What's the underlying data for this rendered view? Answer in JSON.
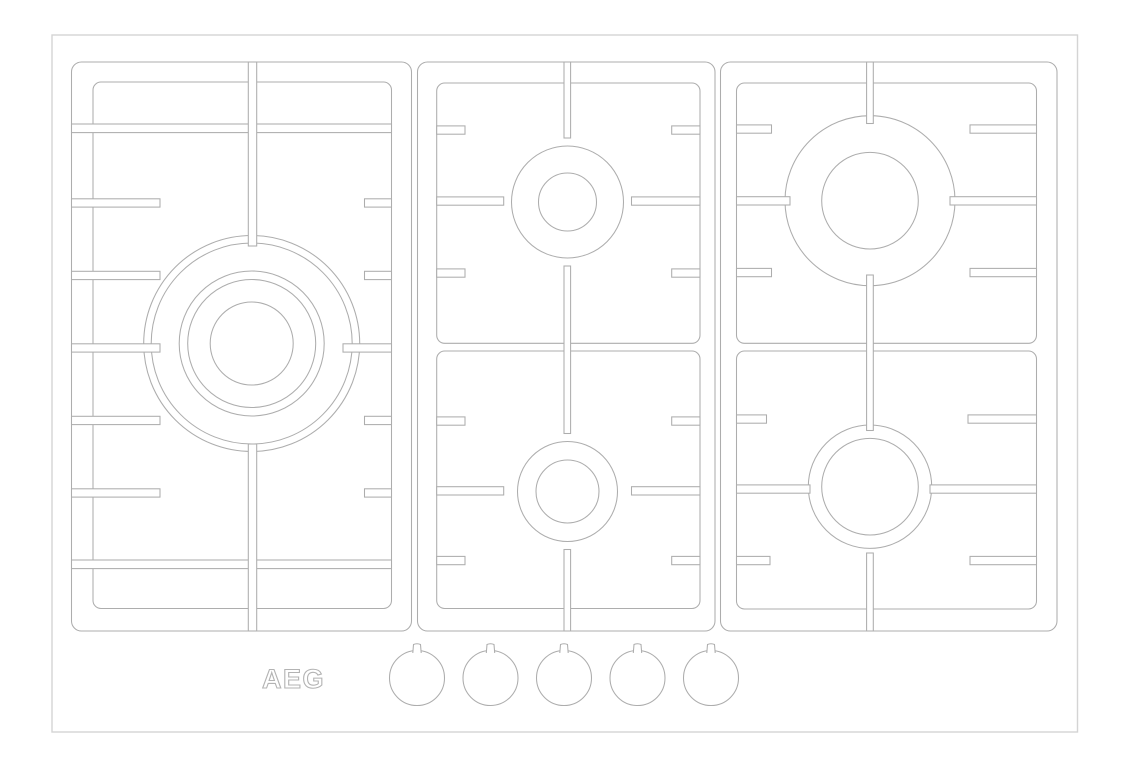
{
  "meta": {
    "width": 1129,
    "height": 768,
    "bg": "#ffffff",
    "description": "Line drawing, top view of AEG 5-burner gas cooktop with pan supports and control knobs"
  },
  "colors": {
    "line": "#adadad",
    "outer_edge": "#d4d4d4",
    "logo": "#b3b3b3",
    "fill": "#ffffff"
  },
  "logo": {
    "text": "AEG",
    "x": 262,
    "y": 688,
    "font_size": 27,
    "letter_spacing": 1.5
  },
  "cooktop": {
    "outer_rect": [
      52,
      35,
      1025.5,
      697
    ]
  },
  "panels": [
    {
      "name": "left",
      "outer": [
        71.5,
        62,
        340,
        569
      ],
      "outer_radius": 10,
      "inner": [
        [
          93,
          82,
          298.5,
          526.5
        ]
      ],
      "inner_radius": 8,
      "burners": [
        {
          "name": "wok-triple-crown-burner",
          "cx": 251.7,
          "cy": 343.5,
          "radii": [
            108,
            100.5,
            72.5,
            64,
            41.5
          ]
        }
      ],
      "hbars": [
        [
          71.5,
          124,
          320,
          8.6
        ],
        [
          71.5,
          560,
          320,
          8.6
        ],
        [
          71.5,
          198.8,
          88.5,
          8.3
        ],
        [
          71.5,
          271.3,
          88.5,
          8.3
        ],
        [
          71.5,
          343.8,
          88.5,
          8.3
        ],
        [
          71.5,
          416.3,
          88.5,
          8.3
        ],
        [
          71.5,
          488.8,
          88.5,
          8.3
        ],
        [
          364.5,
          198.8,
          27,
          8.3
        ],
        [
          364.5,
          271.3,
          27,
          8.3
        ],
        [
          343,
          343.8,
          48.5,
          8.3
        ],
        [
          364.5,
          416.3,
          27,
          8.3
        ],
        [
          364.5,
          488.8,
          27,
          8.3
        ]
      ],
      "vbars": [
        [
          248.3,
          62,
          8.4,
          184
        ],
        [
          248.3,
          444,
          8.4,
          187
        ]
      ]
    },
    {
      "name": "middle",
      "outer": [
        417.5,
        62,
        297.5,
        569
      ],
      "outer_radius": 10,
      "inner": [
        [
          436.7,
          83,
          263.3,
          260.3
        ],
        [
          436.7,
          351,
          263.3,
          257.5
        ]
      ],
      "inner_radius": 8,
      "burners": [
        {
          "name": "semi-rapid-burner-top",
          "cx": 567.5,
          "cy": 202,
          "radii": [
            56,
            29
          ]
        },
        {
          "name": "auxiliary-burner-bottom",
          "cx": 567.5,
          "cy": 491.5,
          "radii": [
            50,
            31.5
          ]
        }
      ],
      "hbars": [
        [
          436.7,
          125.9,
          28.3,
          8.3
        ],
        [
          671.7,
          125.9,
          28.3,
          8.3
        ],
        [
          436.7,
          196.9,
          67,
          8.3
        ],
        [
          631.5,
          196.9,
          68.5,
          8.3
        ],
        [
          436.7,
          268.9,
          28.3,
          8.3
        ],
        [
          671.7,
          268.9,
          28.3,
          8.3
        ],
        [
          436.7,
          416.9,
          28.3,
          8.3
        ],
        [
          671.7,
          416.9,
          28.3,
          8.3
        ],
        [
          436.7,
          486.7,
          67,
          8.3
        ],
        [
          631.5,
          486.7,
          68.5,
          8.3
        ],
        [
          436.7,
          556.4,
          28.3,
          8.3
        ],
        [
          671.7,
          556.4,
          28.3,
          8.3
        ]
      ],
      "vbars": [
        [
          564,
          62,
          6.6,
          76
        ],
        [
          564,
          266,
          6.6,
          167.5
        ],
        [
          564,
          549.5,
          6.6,
          81.5
        ]
      ]
    },
    {
      "name": "right",
      "outer": [
        720.5,
        62,
        336.5,
        569
      ],
      "outer_radius": 10,
      "inner": [
        [
          736.5,
          83,
          300,
          260.3
        ],
        [
          736.5,
          351,
          300,
          258
        ]
      ],
      "inner_radius": 8,
      "burners": [
        {
          "name": "rapid-burner-top",
          "cx": 870,
          "cy": 200.7,
          "radii": [
            85,
            48.3
          ]
        },
        {
          "name": "semi-rapid-burner-bottom",
          "cx": 870,
          "cy": 486.7,
          "radii": [
            61.7,
            48.3
          ]
        }
      ],
      "hbars": [
        [
          736.5,
          124.9,
          35,
          8.3
        ],
        [
          970,
          124.9,
          66.5,
          8.3
        ],
        [
          736.5,
          196.7,
          53.5,
          8.3
        ],
        [
          950,
          196.7,
          86.5,
          8.3
        ],
        [
          736.5,
          268.4,
          35,
          8.3
        ],
        [
          970,
          268.4,
          66.5,
          8.3
        ],
        [
          736.5,
          414.9,
          30,
          8.3
        ],
        [
          968,
          414.9,
          68.5,
          8.3
        ],
        [
          736.5,
          484.9,
          73.5,
          8.3
        ],
        [
          930,
          484.9,
          106.5,
          8.3
        ],
        [
          736.5,
          556.4,
          33.5,
          8.3
        ],
        [
          970,
          556.4,
          66.5,
          8.3
        ]
      ],
      "vbars": [
        [
          866.6,
          62,
          6.7,
          61.5
        ],
        [
          866.6,
          275,
          6.7,
          155.5
        ],
        [
          866.6,
          553,
          6.7,
          78
        ]
      ]
    }
  ],
  "knob_row": {
    "radius": 27.5,
    "cy": 678,
    "cx": [
      417,
      490.5,
      564,
      637.5,
      711
    ],
    "nub": {
      "half_top": 3.5,
      "half_base": 4.2,
      "rise": 7.5,
      "sink": 2.5
    }
  }
}
